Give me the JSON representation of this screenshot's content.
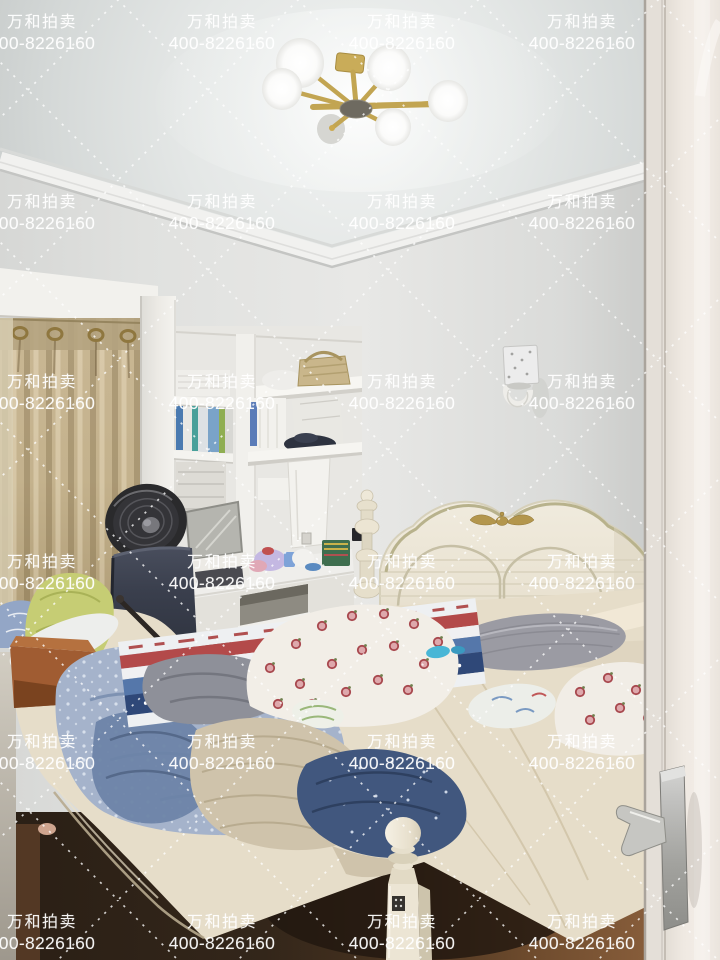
{
  "watermark": {
    "company_name": "万和拍卖",
    "phone": "400-8226160",
    "text_color": "#ffffff",
    "grid": {
      "columns": 4,
      "rows": 6,
      "x_start": 42,
      "x_step": 180,
      "y_start": 14,
      "y_step": 180
    },
    "lattice_style": "white dotted diamond lines"
  },
  "scene": {
    "type": "bedroom interior photograph",
    "objects": [
      {
        "name": "chandelier",
        "desc": "gold 6-globe sputnik ceiling lamp",
        "color": "#c9ac59"
      },
      {
        "name": "crown-molding",
        "color": "#f1f1ef"
      },
      {
        "name": "window-curtain",
        "color": "#c6b28c"
      },
      {
        "name": "wall-shelves",
        "color": "#f4f3ef"
      },
      {
        "name": "pedestal-fan",
        "color": "#2a2a2c"
      },
      {
        "name": "office-chair",
        "color": "#363b49"
      },
      {
        "name": "study-desk",
        "color": "#efeeea"
      },
      {
        "name": "wall-lamp",
        "color": "#ececec"
      },
      {
        "name": "bed-headboard",
        "color": "#ece6d8"
      },
      {
        "name": "gray-pillow",
        "color": "#9b9ba3"
      },
      {
        "name": "fruit-print-quilt",
        "color": "#f2eee7"
      },
      {
        "name": "light-blue-quilt",
        "color": "#a5b3cb"
      },
      {
        "name": "navy-quilt",
        "color": "#41577e"
      },
      {
        "name": "knit-blanket",
        "color": "#cfc3ab"
      },
      {
        "name": "green-blanket",
        "color": "#c6cd74"
      },
      {
        "name": "bed-frame",
        "color": "#e6ddc9"
      },
      {
        "name": "wood-floor",
        "color": "#6e4a2e"
      },
      {
        "name": "door",
        "color": "#eee8e2"
      },
      {
        "name": "door-handle",
        "color": "#c6c6c2"
      }
    ]
  }
}
